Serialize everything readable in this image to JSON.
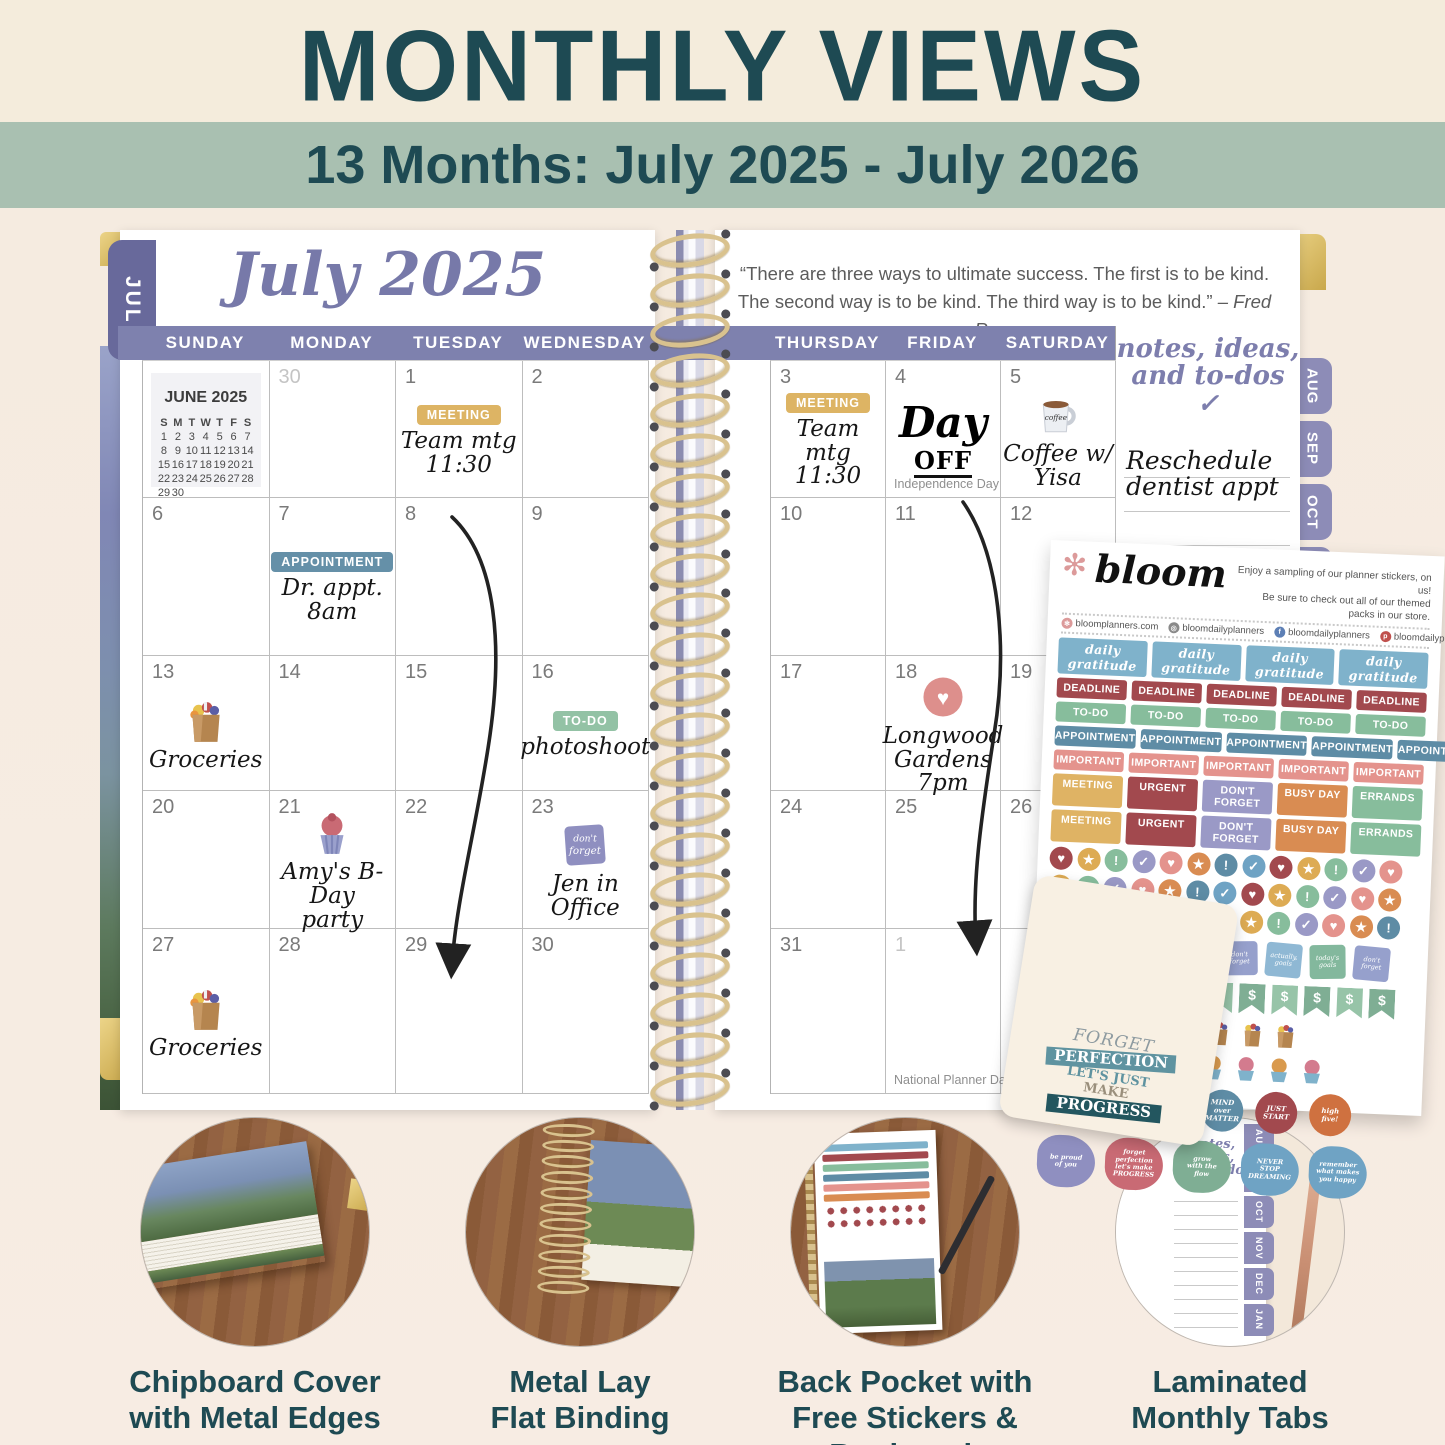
{
  "header": {
    "title": "MONTHLY VIEWS",
    "subtitle": "13 Months: July 2025 - July 2026"
  },
  "planner": {
    "left_tab": "JUL",
    "month_tabs": [
      "AUG",
      "SEP",
      "OCT",
      "NOV"
    ],
    "left_page": {
      "title": "July 2025",
      "day_headers": [
        "SUNDAY",
        "MONDAY",
        "TUESDAY",
        "WEDNESDAY"
      ],
      "mini_calendar": {
        "title": "JUNE 2025",
        "dow": "S M T W T F S",
        "weeks": [
          "1 2 3 4 5 6 7",
          "8 9 10 11 12 13 14",
          "15 16 17 18 19 20 21",
          "22 23 24 25 26 27 28",
          "29 30"
        ]
      },
      "weeks": [
        [
          {
            "minical": true
          },
          {
            "num": "30",
            "muted": true
          },
          {
            "num": "1",
            "sticker": {
              "text": "MEETING",
              "color": "#ddb464"
            },
            "note": "Team mtg\n11:30"
          },
          {
            "num": "2"
          }
        ],
        [
          {
            "num": "6"
          },
          {
            "num": "7",
            "sticker": {
              "text": "APPOINTMENT",
              "color": "#6590a8"
            },
            "note": "Dr. appt.\n8am"
          },
          {
            "num": "8"
          },
          {
            "num": "9"
          }
        ],
        [
          {
            "num": "13",
            "icon": "grocery-bag",
            "note": "Groceries"
          },
          {
            "num": "14"
          },
          {
            "num": "15"
          },
          {
            "num": "16",
            "sticker": {
              "text": "TO-DO",
              "color": "#93c2a5"
            },
            "note": "photoshoot"
          }
        ],
        [
          {
            "num": "20"
          },
          {
            "num": "21",
            "icon": "cupcake",
            "note": "Amy's B-Day\nparty"
          },
          {
            "num": "22"
          },
          {
            "num": "23",
            "icon": "dont-forget",
            "note": "Jen in Office"
          }
        ],
        [
          {
            "num": "27",
            "icon": "grocery-bag",
            "note": "Groceries"
          },
          {
            "num": "28"
          },
          {
            "num": "29"
          },
          {
            "num": "30"
          }
        ]
      ]
    },
    "right_page": {
      "quote_line1": "“There are three ways to ultimate success. The first is to be kind.",
      "quote_line2": "The second way is to be kind. The third way is to be kind.”",
      "quote_attribution": "– Fred Rogers",
      "day_headers": [
        "THURSDAY",
        "FRIDAY",
        "SATURDAY"
      ],
      "notes_title_line1": "notes, ideas,",
      "notes_title_line2": "and to-dos ✓",
      "notes_entry": "Reschedule\ndentist appt",
      "mini_august_numbers": [
        "S",
        "3",
        "10",
        "17",
        "24",
        "31"
      ],
      "weeks": [
        [
          {
            "num": "3",
            "sticker": {
              "text": "MEETING",
              "color": "#ddb464"
            },
            "note": "Team mtg\n11:30"
          },
          {
            "num": "4",
            "big_note": [
              "Day",
              "OFF"
            ],
            "holiday": "Independence Day"
          },
          {
            "num": "5",
            "icon": "coffee-mug",
            "note": "Coffee w/\nYisa"
          }
        ],
        [
          {
            "num": "10"
          },
          {
            "num": "11"
          },
          {
            "num": "12"
          }
        ],
        [
          {
            "num": "17"
          },
          {
            "num": "18",
            "icon": "heart-circle",
            "note": "Longwood\nGardens\n7pm"
          },
          {
            "num": "19"
          }
        ],
        [
          {
            "num": "24"
          },
          {
            "num": "25"
          },
          {
            "num": "26"
          }
        ],
        [
          {
            "num": "31"
          },
          {
            "num": "1",
            "muted": true,
            "holiday": "National Planner Day"
          },
          {
            "num": ""
          }
        ]
      ]
    }
  },
  "sticker_sheet": {
    "brand": "bloom",
    "brand_icon": "flower-icon",
    "tagline": "Enjoy a sampling of our planner stickers, on us!\nBe sure to check out all of our themed packs in our store.",
    "social": [
      {
        "icon": "flower-icon",
        "color": "#dc9a9a",
        "text": "bloomplanners.com"
      },
      {
        "icon": "instagram-icon",
        "color": "#8a8a8a",
        "text": "bloomdailyplanners"
      },
      {
        "icon": "facebook-icon",
        "color": "#5d7fb5",
        "text": "bloomdailyplanners"
      },
      {
        "icon": "pinterest-icon",
        "color": "#c0504d",
        "text": "bloomdailyplanners"
      }
    ],
    "script_row": {
      "text": "daily gratitude",
      "count": 4,
      "color": "#7fb2cb"
    },
    "label_rows": [
      {
        "text": "DEADLINE",
        "count": 5,
        "color": "#a2494e"
      },
      {
        "text": "TO-DO",
        "count": 5,
        "color": "#87bd9c"
      },
      {
        "text": "APPOINTMENT",
        "count": 5,
        "color": "#5e8ca5"
      },
      {
        "text": "IMPORTANT",
        "count": 5,
        "color": "#e4938d"
      }
    ],
    "mixed_rows": [
      [
        {
          "text": "MEETING",
          "color": "#dfb364"
        },
        {
          "text": "URGENT",
          "color": "#a2494e"
        },
        {
          "text": "DON'T FORGET",
          "color": "#9a99c6"
        },
        {
          "text": "BUSY DAY",
          "color": "#d98c52"
        },
        {
          "text": "ERRANDS",
          "color": "#87bd9c"
        }
      ],
      [
        {
          "text": "MEETING",
          "color": "#dfb364"
        },
        {
          "text": "URGENT",
          "color": "#a2494e"
        },
        {
          "text": "DON'T FORGET",
          "color": "#9a99c6"
        },
        {
          "text": "BUSY DAY",
          "color": "#d98c52"
        },
        {
          "text": "ERRANDS",
          "color": "#87bd9c"
        }
      ]
    ],
    "dot_rows": 3,
    "dots_per_row": 13,
    "dot_cycle": [
      {
        "glyph": "♥",
        "color": "#a2494e"
      },
      {
        "glyph": "★",
        "color": "#ddab54"
      },
      {
        "glyph": "!",
        "color": "#87bd9c"
      },
      {
        "glyph": "✓",
        "color": "#9a99c6"
      },
      {
        "glyph": "♥",
        "color": "#e4938d"
      },
      {
        "glyph": "★",
        "color": "#d98c52"
      },
      {
        "glyph": "!",
        "color": "#5e8ca5"
      },
      {
        "glyph": "✓",
        "color": "#6fa3c4"
      }
    ],
    "square_row": {
      "count": 8,
      "labels": [
        "today's\ngoals",
        "don't\nforget",
        "actually,\ngoals"
      ],
      "colors": [
        "#83b89d",
        "#96a0cc",
        "#8fb8d4"
      ]
    },
    "dollar_row": {
      "symbol": "$",
      "count": 11,
      "colors": [
        "#7fae94",
        "#97c4a8"
      ]
    },
    "bag_count": 8,
    "cake_count": 5,
    "cupcake_count": 4,
    "round_row": [
      {
        "type": "sun",
        "color": "#e2b54e",
        "text": ""
      },
      {
        "type": "landscape",
        "color": "#7fa8c9",
        "text": ""
      },
      {
        "type": "text",
        "color": "#9a99c6",
        "text": "push\nyour\nself"
      },
      {
        "type": "text",
        "color": "#5e8ca5",
        "text": "MIND\nover\nMATTER"
      },
      {
        "type": "text",
        "color": "#a2494e",
        "text": "JUST\nSTART"
      },
      {
        "type": "text",
        "color": "#cf7140",
        "text": "high\nfive!"
      }
    ],
    "bottom_row": [
      {
        "color": "#8f8fc0",
        "text": "be proud\nof you"
      },
      {
        "color": "#c96a74",
        "text": "forget\nperfection\nlet's make\nPROGRESS"
      },
      {
        "color": "#7fae94",
        "text": "grow\nwith the\nflow"
      },
      {
        "color": "#6fa3c4",
        "text": "NEVER\nSTOP\nDREAMING"
      },
      {
        "color": "#6fa3c4",
        "text": "remember\nwhat makes\nyou happy"
      }
    ]
  },
  "bookmark": {
    "lines": [
      "FORGET",
      "PERFECTION",
      "LET'S JUST",
      "MAKE",
      "PROGRESS"
    ]
  },
  "features": [
    {
      "caption": "Chipboard Cover\nwith Metal Edges"
    },
    {
      "caption": "Metal Lay\nFlat Binding"
    },
    {
      "caption": "Back Pocket with\nFree Stickers & Bookmark"
    },
    {
      "caption": "Laminated\nMonthly Tabs",
      "tabs": [
        "AUG",
        "SEP",
        "OCT",
        "NOV",
        "DEC",
        "JAN"
      ]
    }
  ]
}
